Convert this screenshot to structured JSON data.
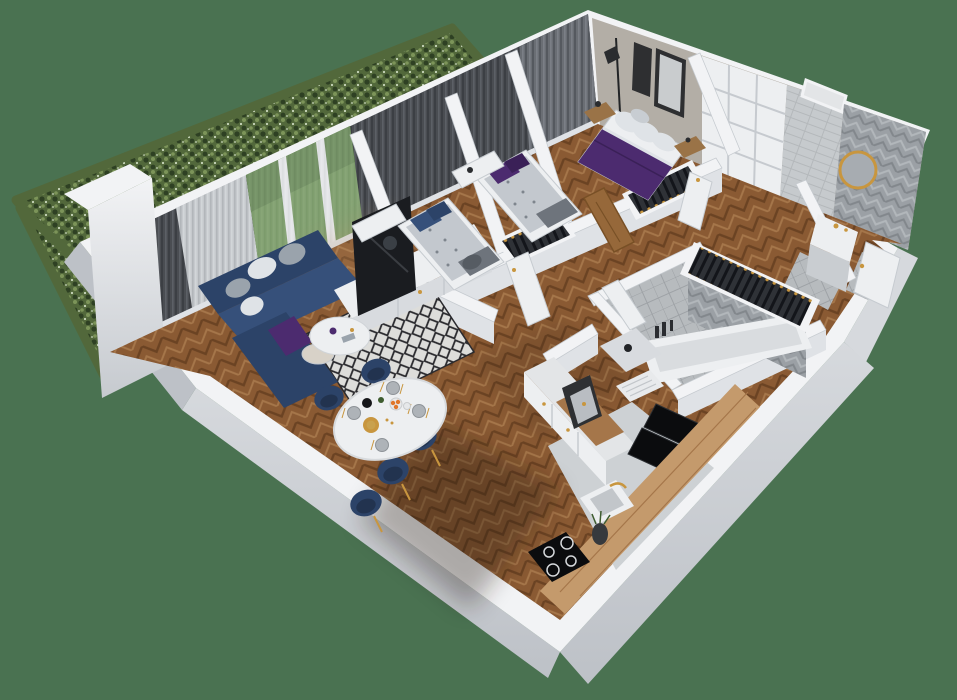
{
  "scene": {
    "label": "3D isometric cutaway floor plan render of an apartment with green hedge exterior",
    "view": "axonometric-cutaway",
    "rooms": [
      {
        "name": "living-room",
        "furniture": [
          "navy-corner-sofa",
          "round-coffee-table",
          "side-table",
          "diamond-rug",
          "tv-screen",
          "white-sideboard"
        ]
      },
      {
        "name": "dining-area",
        "furniture": [
          "white-oval-table",
          "navy-gold-chairs",
          "plates",
          "gold-cutlery",
          "fruit-bowl",
          "black-kettle"
        ]
      },
      {
        "name": "kitchen",
        "furniture": [
          "white-cabinet-run",
          "coffee-machine",
          "dish-rack",
          "black-appliances",
          "wood-counter",
          "sink-gold-faucet",
          "induction-hob",
          "plant-vase"
        ]
      },
      {
        "name": "bedroom-1",
        "furniture": [
          "single-bed-blue-pillows",
          "white-desk",
          "clothes-rack"
        ]
      },
      {
        "name": "bedroom-2",
        "furniture": [
          "single-bed-purple-pillows",
          "white-desk",
          "clothes-rack"
        ]
      },
      {
        "name": "master-bedroom",
        "furniture": [
          "double-bed-purple-spread",
          "nightstand-left",
          "nightstand-right",
          "floor-lamp",
          "framed-wall-art",
          "gray-curtains"
        ]
      },
      {
        "name": "bathroom",
        "furniture": [
          "bathtub",
          "herringbone-accent-wall",
          "clothes-rack",
          "storage-unit",
          "toiletries"
        ]
      },
      {
        "name": "shower-room",
        "furniture": [
          "gold-round-mirror",
          "vanity-sink-gold-faucet",
          "herringbone-wall"
        ]
      },
      {
        "name": "hallway",
        "furniture": [
          "oak-door",
          "white-panel-doors",
          "built-in-wardrobe",
          "tiled-duct"
        ]
      },
      {
        "name": "exterior",
        "furniture": [
          "hedge",
          "lawn-grass"
        ]
      }
    ]
  },
  "colors": {
    "bg": "#4A7251",
    "hedge-dark": "#2E4023",
    "hedge-mid": "#52683B",
    "hedge-light": "#7C9459",
    "hedge-tip": "#CBD8BD",
    "wall-top": "#F2F3F5",
    "wall-face": "#DFE2E6",
    "wall-face-dark": "#C6CACF",
    "wall-outer": "#D6D9DD",
    "wall-outer-dark": "#BDC1C7",
    "wall-line": "#C6CBD0",
    "greige": "#B3AEA6",
    "curtain-dark": "#4A4D52",
    "curtain-dark2": "#3C3F44",
    "curtain-hi": "#5C6066",
    "curtain-mid": "#6A6E74",
    "curtain-mid-hi": "#7B7F86",
    "curtain-mid-lo": "#55595F",
    "sheer": "#C6C9CD",
    "sheer-hi": "#D6D9DC",
    "sheer-lo": "#B2B6BA",
    "grass": "#5F8C42",
    "grass-dark": "#48722F",
    "wood-mid": "#8A5A33",
    "wood-dark": "#6B4323",
    "wood-light": "#A5764A",
    "wood-pale": "#C09468",
    "wood-counter": "#C49A6C",
    "tile": "#B7BBBE",
    "tile-line": "#9EA2A6",
    "chev-base": "#9BA0A5",
    "chev-light": "#B2B7BB",
    "chev-dark": "#82878C",
    "duct": "#C6CACD",
    "duct-line": "#B4B8BB",
    "marble": "#E3E5E7",
    "kitchen-floor": "#CDD1D4",
    "white-furn": "#EDEFF1",
    "white-furn-shade": "#D8DBDF",
    "navy": "#2C4368",
    "navy-dark": "#22334F",
    "navy-mid": "#36507A",
    "pillow-gray": "#9AA3AC",
    "pillow-light": "#DFE3E7",
    "purple": "#4C2B6F",
    "purple-dark": "#3A2057",
    "duvet": "#C3C8CE",
    "duvet-dot": "#7E858D",
    "blanket": "#6E747C",
    "rug-base": "#DDDDDA",
    "rug-dark": "#2A2A2E",
    "tv": "#1A1C20",
    "black-app": "#0B0C0E",
    "gold": "#C8963F",
    "wood-door": "#96683A",
    "wood-door-dark": "#785026",
    "closet-dark": "#2F3237",
    "slat": "#13151A",
    "nightstand": "#9A7347",
    "orange": "#E0762A",
    "shadow": "#201810"
  }
}
